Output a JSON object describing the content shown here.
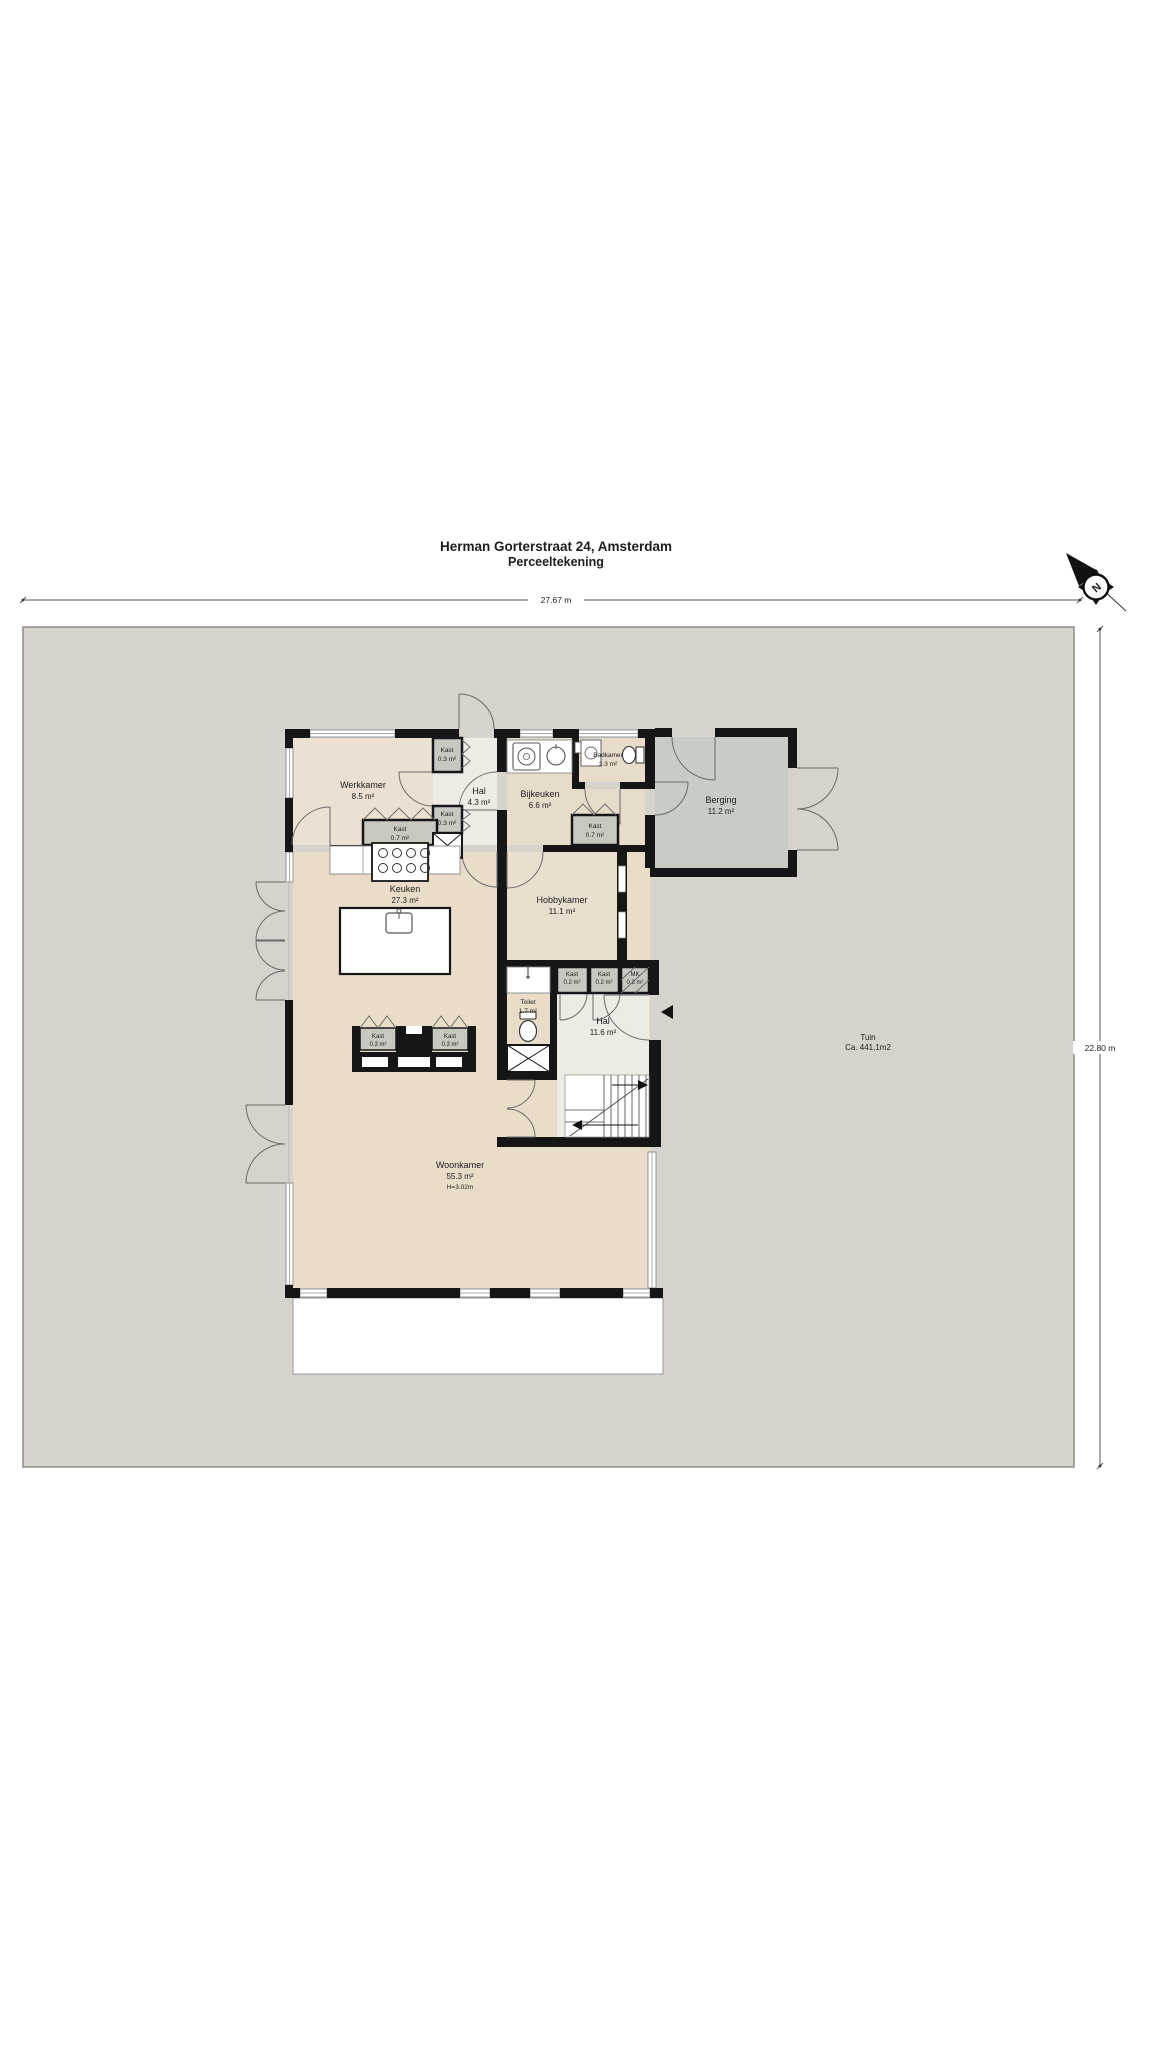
{
  "title": {
    "line1": "Herman Gorterstraat 24, Amsterdam",
    "line2": "Perceeltekening"
  },
  "dimensions": {
    "width": "27.67 m",
    "height": "22.80 m"
  },
  "compass": {
    "north": "N"
  },
  "garden": {
    "name": "Tuin",
    "area": "Ca. 441,1m2"
  },
  "rooms": {
    "werkkamer": {
      "name": "Werkkamer",
      "area": "8.5 m²"
    },
    "kast_hal_boven": {
      "name": "Kast",
      "area": "0.3 m²"
    },
    "kast_hal_onder": {
      "name": "Kast",
      "area": "0.3 m²"
    },
    "hal_voor": {
      "name": "Hal",
      "area": "4.3 m²"
    },
    "bijkeuken": {
      "name": "Bijkeuken",
      "area": "6.6 m²"
    },
    "badkamer": {
      "name": "Badkamer",
      "area": "2.3 m²"
    },
    "kast_werkkamer": {
      "name": "Kast",
      "area": "0.7 m²"
    },
    "kast_bijkeuken": {
      "name": "Kast",
      "area": "0.7 m²"
    },
    "berging": {
      "name": "Berging",
      "area": "11.2 m²"
    },
    "keuken": {
      "name": "Keuken",
      "area": "27.3 m²"
    },
    "hobbykamer": {
      "name": "Hobbykamer",
      "area": "11.1 m²"
    },
    "toilet": {
      "name": "Toilet",
      "area": "1.7 m²"
    },
    "kast_hal_1": {
      "name": "Kast",
      "area": "0.2 m²"
    },
    "kast_hal_2": {
      "name": "Kast",
      "area": "0.2 m²"
    },
    "meterkast": {
      "name": "MK",
      "area": "0.3 m²"
    },
    "hal_achter": {
      "name": "Hal",
      "area": "11.6 m²"
    },
    "woonkamer": {
      "name": "Woonkamer",
      "area": "55.3 m²",
      "height": "H=3.02m"
    },
    "kast_woonkamer_links": {
      "name": "Kast",
      "area": "0.3 m²"
    },
    "kast_woonkamer_rechts": {
      "name": "Kast",
      "area": "0.3 m²"
    }
  },
  "colors": {
    "wall": "#161616",
    "floor_beige": "#e9dcc9",
    "floor_light": "#edece5",
    "floor_storage": "#c7cdc5",
    "closet_gray": "#c8c8c1",
    "garden_gray": "#d5d3cc"
  }
}
